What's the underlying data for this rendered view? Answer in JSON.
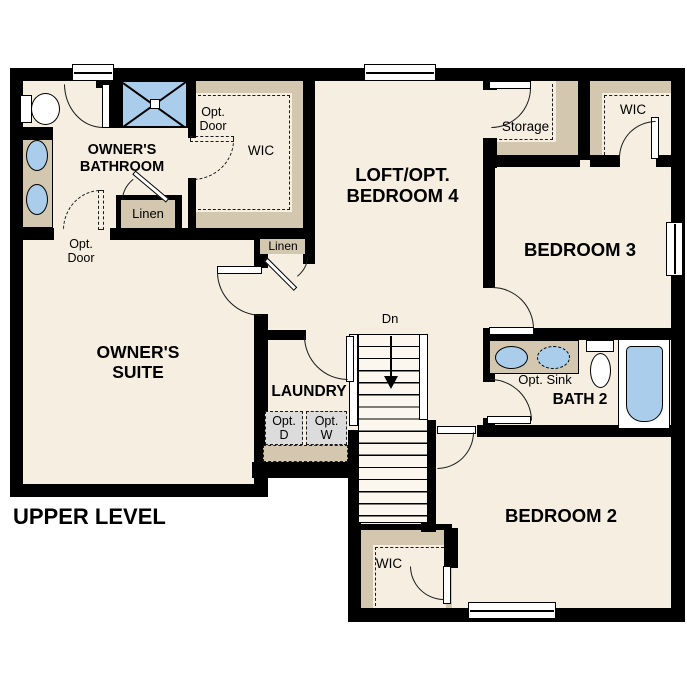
{
  "plan_title": "UPPER LEVEL",
  "rooms": {
    "owners_bathroom": "OWNER'S\nBATHROOM",
    "owners_suite": "OWNER'S\nSUITE",
    "loft": "LOFT/OPT.\nBEDROOM 4",
    "bedroom_3": "BEDROOM 3",
    "bedroom_2": "BEDROOM 2",
    "bath_2": "BATH 2",
    "laundry": "LAUNDRY"
  },
  "closets": {
    "wic_loft": "WIC",
    "wic_bedroom_3": "WIC",
    "wic_bedroom_2": "WIC",
    "storage": "Storage",
    "linen_bathroom": "Linen",
    "linen_hall": "Linen"
  },
  "annotations": {
    "opt_door_suite": "Opt.\nDoor",
    "opt_door_wic": "Opt.\nDoor",
    "opt_sink": "Opt. Sink",
    "opt_dryer": "Opt.\nD",
    "opt_washer": "Opt.\nW",
    "stair_direction": "Dn"
  },
  "colors": {
    "wall": "#000000",
    "floor": "#f6eee1",
    "closet": "#d4c7af",
    "fixture_blue": "#a9cdea",
    "appliance": "#dcdcdc",
    "stair": "#fbf7ee",
    "page": "#ffffff",
    "line": "#1a1a1a"
  }
}
